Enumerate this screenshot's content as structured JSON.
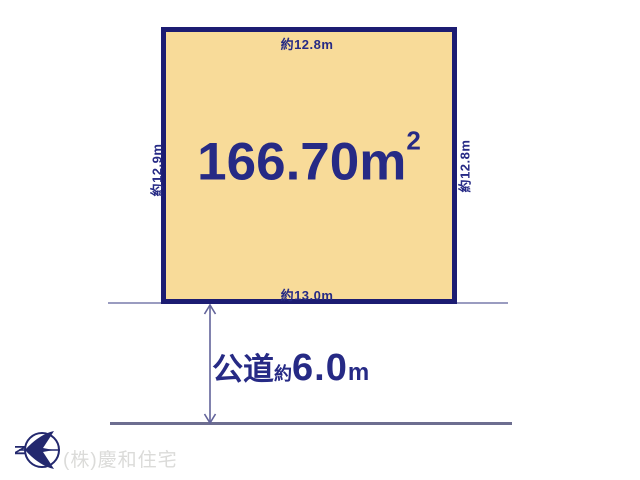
{
  "plot": {
    "area_value": "166.70m",
    "area_sup": "2",
    "top_dimension": "約12.8m",
    "left_dimension": "約12.9m",
    "right_dimension": "約12.8m",
    "bottom_dimension": "約13.0m"
  },
  "road": {
    "type_label": "公道",
    "approx_label": "約",
    "width_value": "6.0",
    "unit_label": "m"
  },
  "compass": {
    "north_letter": "N"
  },
  "footer": {
    "company_name": "(株)慶和住宅"
  },
  "colors": {
    "plot_fill": "#F8DB99",
    "plot_border": "#1C1C72",
    "navy_text": "#262A85",
    "road_line_upper": "#9A9CC0",
    "road_line_lower": "#6D6E90",
    "arrow": "#62639A",
    "company_text": "#DBDBD9",
    "page_bg": "#FFFFFF"
  }
}
